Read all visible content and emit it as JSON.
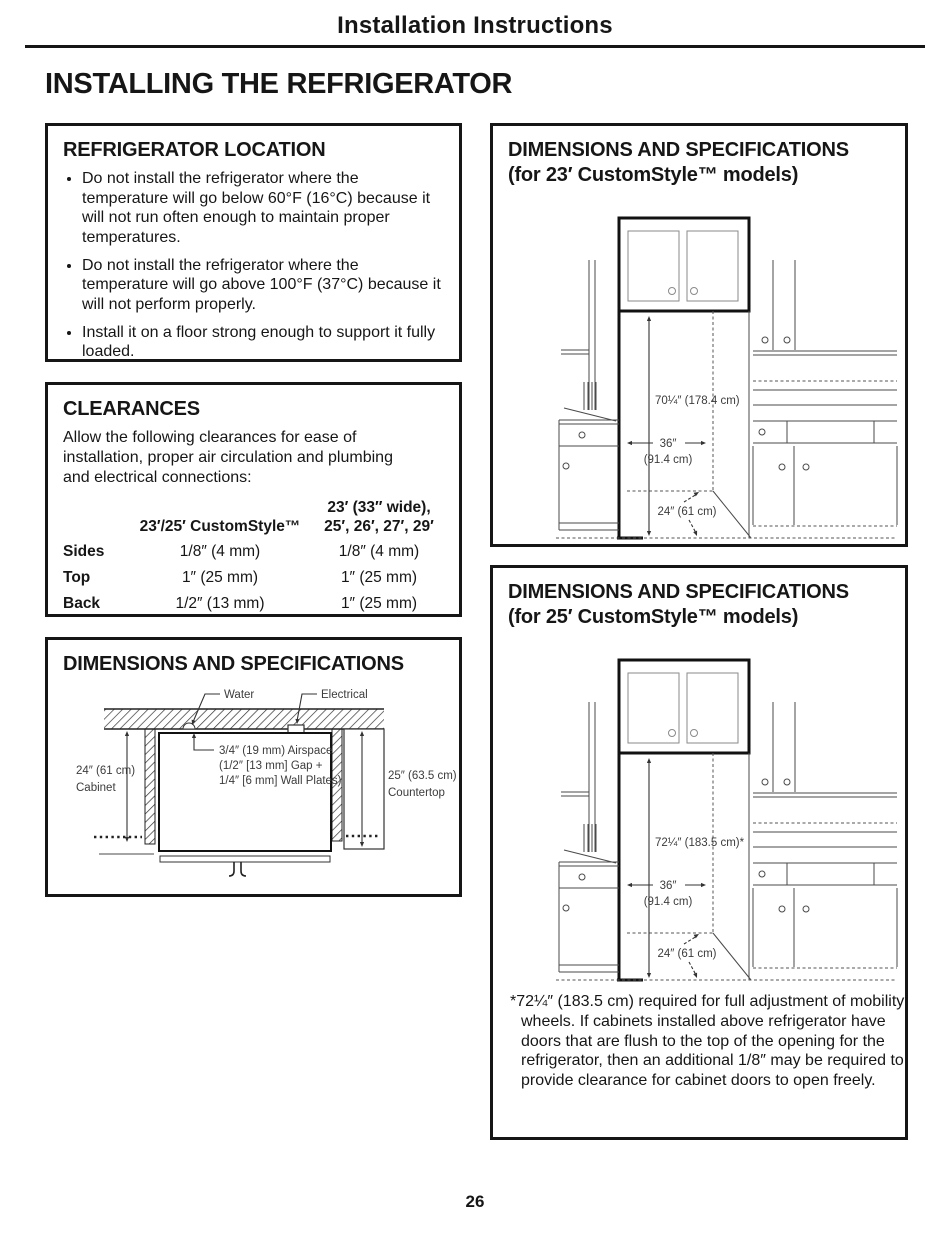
{
  "header": {
    "title": "Installation Instructions"
  },
  "page_title": "INSTALLING THE REFRIGERATOR",
  "page_number": "26",
  "location": {
    "title": "REFRIGERATOR LOCATION",
    "bullets": [
      "Do not install the refrigerator where the temperature will go below 60°F (16°C) because it will not run often enough to maintain proper temperatures.",
      "Do not install the refrigerator where the temperature will go above 100°F (37°C) because it will not perform properly.",
      "Install it on a floor strong enough to support it fully loaded."
    ]
  },
  "clearances": {
    "title": "CLEARANCES",
    "intro": "Allow the following clearances for ease of installation, proper air circulation and plumbing and electrical connections:",
    "table": {
      "col2_header": "23′/25′ CustomStyle™",
      "col3_header_line1": "23′ (33″ wide),",
      "col3_header_line2": "25′, 26′, 27′, 29′",
      "rows": [
        {
          "label": "Sides",
          "col2": "1/8″ (4 mm)",
          "col3": "1/8″ (4 mm)"
        },
        {
          "label": "Top",
          "col2": "1″ (25 mm)",
          "col3": "1″ (25 mm)"
        },
        {
          "label": "Back",
          "col2": "1/2″ (13 mm)",
          "col3": "1″ (25 mm)"
        }
      ]
    }
  },
  "dimensions_box": {
    "title": "DIMENSIONS AND SPECIFICATIONS",
    "labels": {
      "water": "Water",
      "electrical": "Electrical",
      "airspace_line1": "3/4″ (19 mm) Airspace",
      "airspace_line2": "(1/2″ [13 mm] Gap +",
      "airspace_line3": "1/4″ [6 mm] Wall Plates)",
      "cabinet_line1": "24″ (61 cm)",
      "cabinet_line2": "Cabinet",
      "countertop_line1": "25″ (63.5 cm)",
      "countertop_line2": "Countertop"
    }
  },
  "dims_23": {
    "title_line1": "DIMENSIONS AND SPECIFICATIONS",
    "title_line2": "(for 23′ CustomStyle™ models)",
    "height": "70¼″ (178.4 cm)",
    "width_line1": "36″",
    "width_line2": "(91.4 cm)",
    "depth": "24″ (61 cm)"
  },
  "dims_25": {
    "title_line1": "DIMENSIONS AND SPECIFICATIONS",
    "title_line2": "(for 25′ CustomStyle™ models)",
    "height": "72¼″ (183.5 cm)*",
    "width_line1": "36″",
    "width_line2": "(91.4 cm)",
    "depth": "24″ (61 cm)",
    "footnote": "*72¼″ (183.5 cm) required for full adjustment of mobility wheels. If cabinets installed above refrigerator have doors that are flush to the top of the opening for the refrigerator, then an additional 1/8″ may be required to provide clearance for cabinet doors to open freely."
  }
}
